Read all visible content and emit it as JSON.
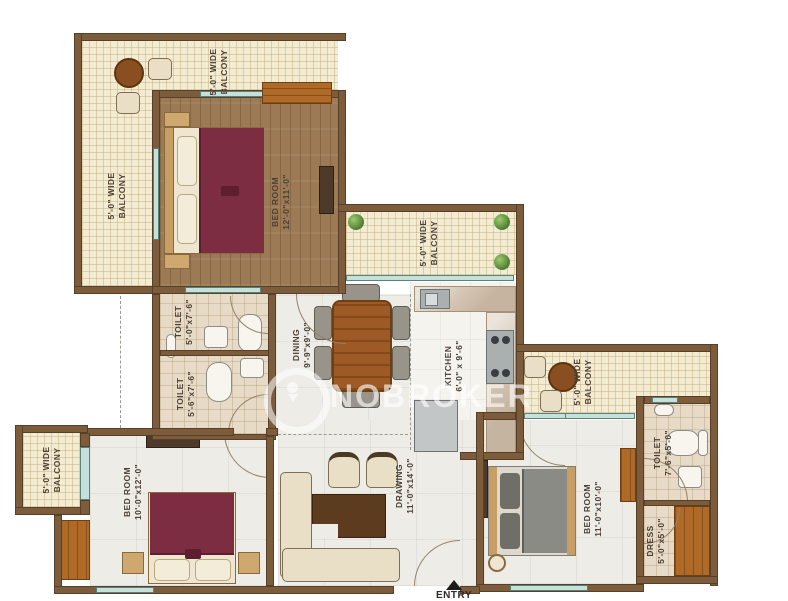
{
  "watermark": {
    "brand": "NOBROKER"
  },
  "entry": {
    "label": "ENTRY"
  },
  "rooms": [
    {
      "id": "balcony-top",
      "line1": "5'-0\" WIDE",
      "line2": "BALCONY"
    },
    {
      "id": "balcony-left",
      "line1": "5'-0\" WIDE",
      "line2": "BALCONY"
    },
    {
      "id": "bedroom-top",
      "line1": "BED ROOM",
      "line2": "12'-0\"x11'-0\""
    },
    {
      "id": "balcony-middle",
      "line1": "5'-0\" WIDE",
      "line2": "BALCONY"
    },
    {
      "id": "toilet-upper",
      "line1": "TOILET",
      "line2": "5'-0\"x7'-6\""
    },
    {
      "id": "toilet-lower",
      "line1": "TOILET",
      "line2": "5'-6\"x7'-6\""
    },
    {
      "id": "dining",
      "line1": "DINING",
      "line2": "9'-9\"x9'-0\""
    },
    {
      "id": "kitchen",
      "line1": "KITCHEN",
      "line2": "6'-0\" x 9'-6\""
    },
    {
      "id": "balcony-right",
      "line1": "5'-0\" WIDE",
      "line2": "BALCONY"
    },
    {
      "id": "toilet-right",
      "line1": "TOILET",
      "line2": "7'-6\"x5'-0\""
    },
    {
      "id": "dress",
      "line1": "DRESS",
      "line2": "5'-0\"x5'-0\""
    },
    {
      "id": "bedroom-right",
      "line1": "BED ROOM",
      "line2": "11'-0\"x10'-0\""
    },
    {
      "id": "bedroom-left",
      "line1": "BED ROOM",
      "line2": "10'-0\"x12'-0\""
    },
    {
      "id": "balcony-bottom-left",
      "line1": "5'-0\" WIDE",
      "line2": "BALCONY"
    },
    {
      "id": "drawing",
      "line1": "DRAWING",
      "line2": "11'-0\"x14'-0\""
    }
  ],
  "colors": {
    "wall": "#7d5c3c",
    "balcony_floor": "#f4ebd3",
    "wood_floor": "#9b7a55",
    "room_floor": "#edece6",
    "toilet_floor": "#e7dbc8",
    "window": "#c3e2dc",
    "bed_accent": "#7c2d42",
    "counter": "#d6c8b6",
    "label_text": "#4c4036",
    "watermark_text": "rgba(255,255,255,0.62)"
  }
}
